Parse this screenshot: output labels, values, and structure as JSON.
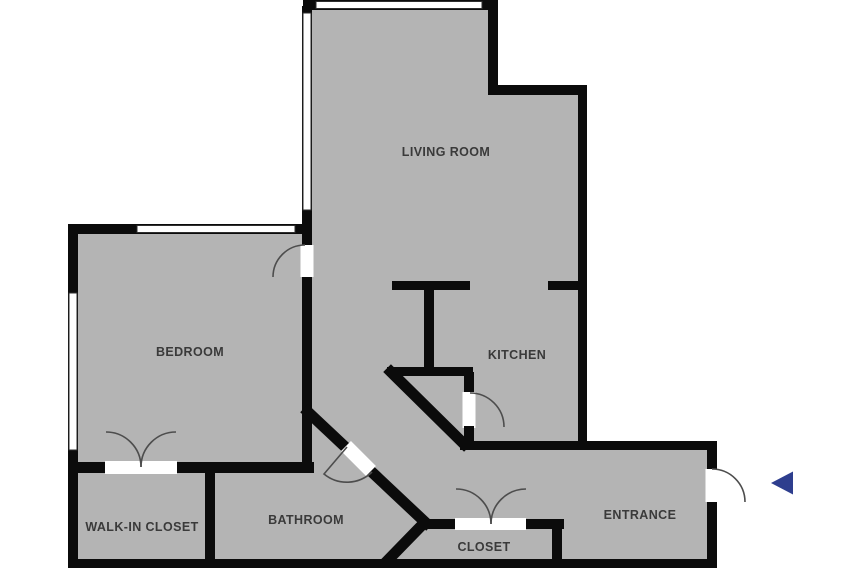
{
  "floorplan": {
    "rooms": {
      "living_room": "LIVING ROOM",
      "bedroom": "BEDROOM",
      "kitchen": "KITCHEN",
      "walk_in_closet": "WALK-IN CLOSET",
      "bathroom": "BATHROOM",
      "closet": "CLOSET",
      "entrance": "ENTRANCE"
    },
    "colors": {
      "floor": "#b4b4b4",
      "wall": "#0b0b0b",
      "door_arc": "#4d4d4d",
      "label": "#3a3a3a",
      "entrance_arrow": "#2e3e8e",
      "background": "#ffffff"
    }
  }
}
